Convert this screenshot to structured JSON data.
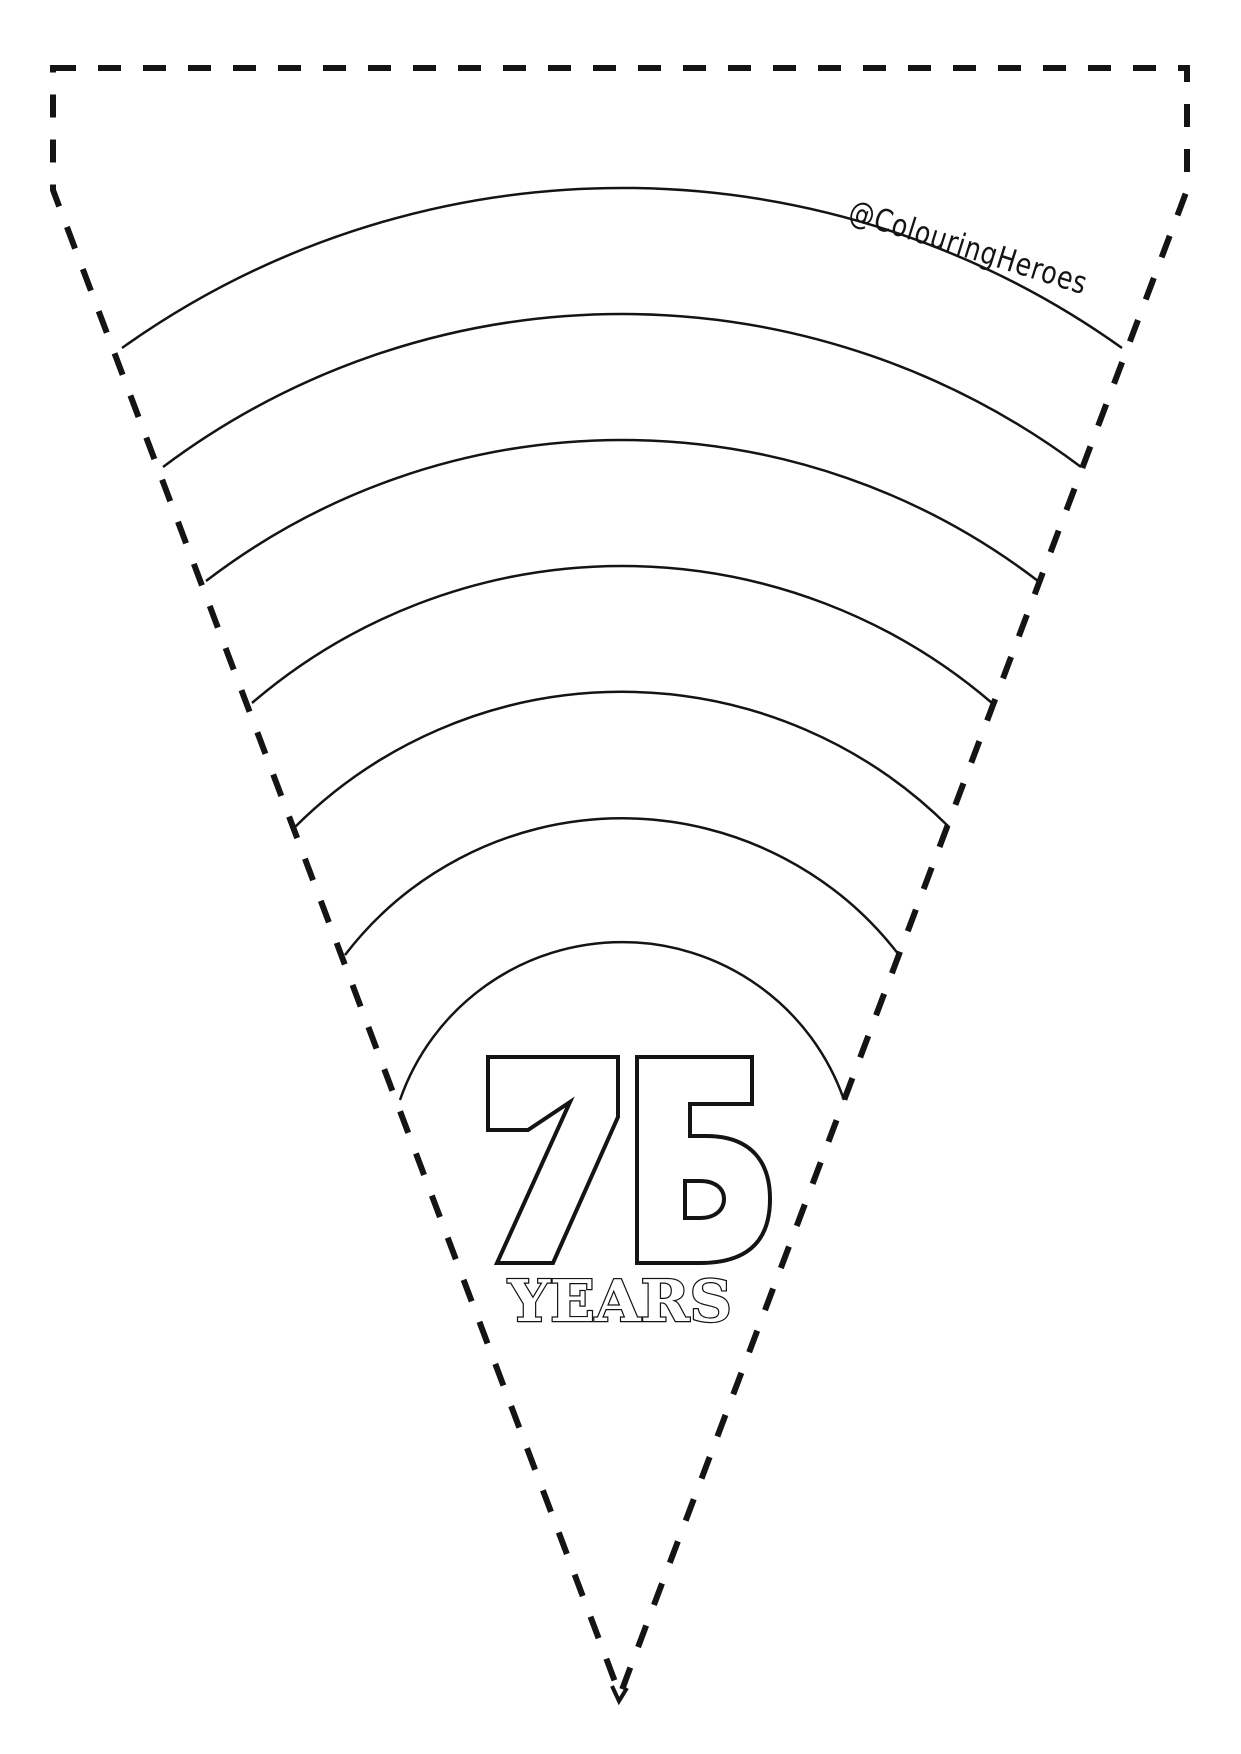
{
  "page": {
    "background": "#ffffff",
    "line_color": "#141414"
  },
  "watermark": {
    "handle": "@ColouringHeroes"
  },
  "badge": {
    "number": "75",
    "label": "YEARS"
  },
  "pennant": {
    "band_count": 7
  }
}
